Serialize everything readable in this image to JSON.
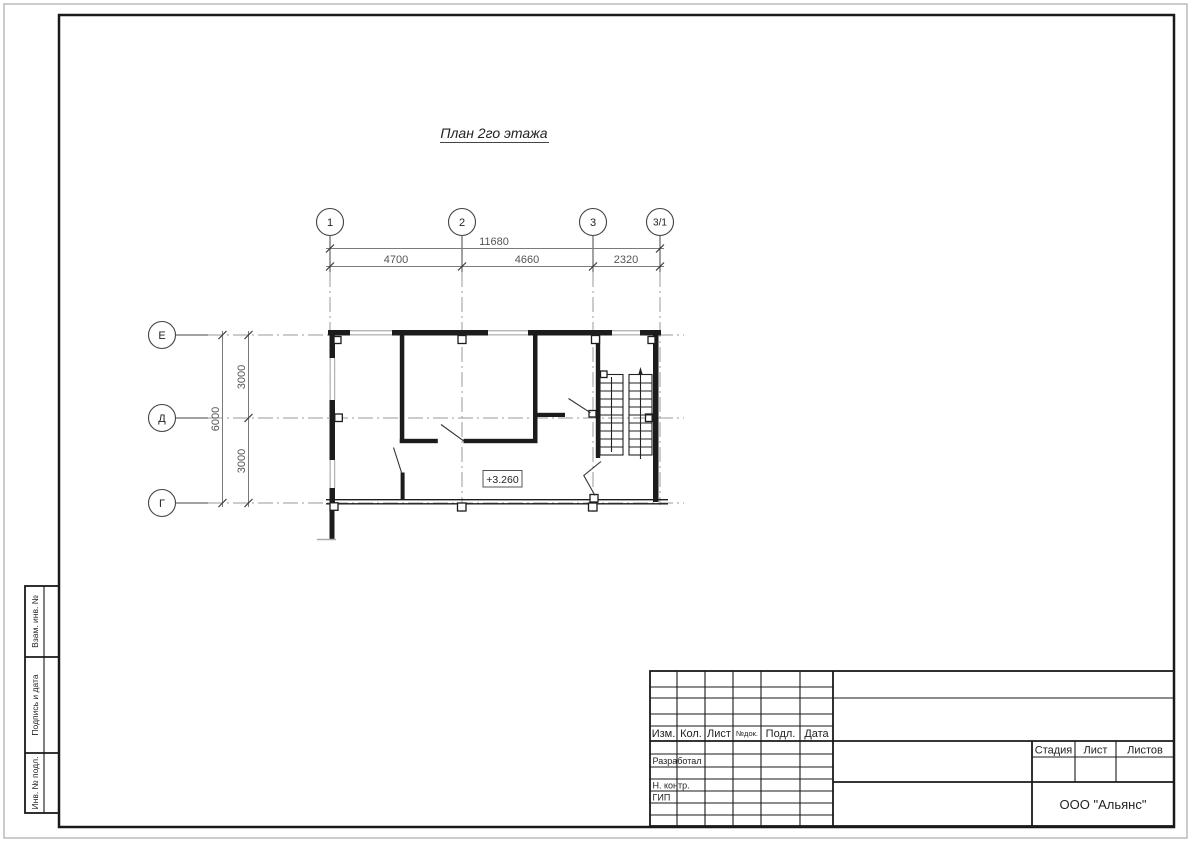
{
  "drawing": {
    "title": "План 2го этажа",
    "level_mark": "+3.260"
  },
  "axes": {
    "top": [
      "1",
      "2",
      "3",
      "3/1"
    ],
    "left": [
      "Е",
      "Д",
      "Г"
    ]
  },
  "dims": {
    "total_w": "11680",
    "span1": "4700",
    "span2": "4660",
    "span3": "2320",
    "total_h": "6000",
    "vspan1": "3000",
    "vspan2": "3000"
  },
  "title_block": {
    "col_izm": "Изм.",
    "col_kol": "Кол.",
    "col_list": "Лист",
    "col_ndok": "№док.",
    "col_podp": "Подл.",
    "col_data": "Дата",
    "role_1": "Разработал",
    "role_2": "Н. контр.",
    "role_3": "ГИП",
    "stage": "Стадия",
    "sheet": "Лист",
    "sheets": "Листов",
    "org": "ООО \"Альянс\""
  },
  "side_strip": {
    "cell_1": "Взам. инв. №",
    "cell_2": "Подпись и дата",
    "cell_3": "Инв. № подл."
  }
}
